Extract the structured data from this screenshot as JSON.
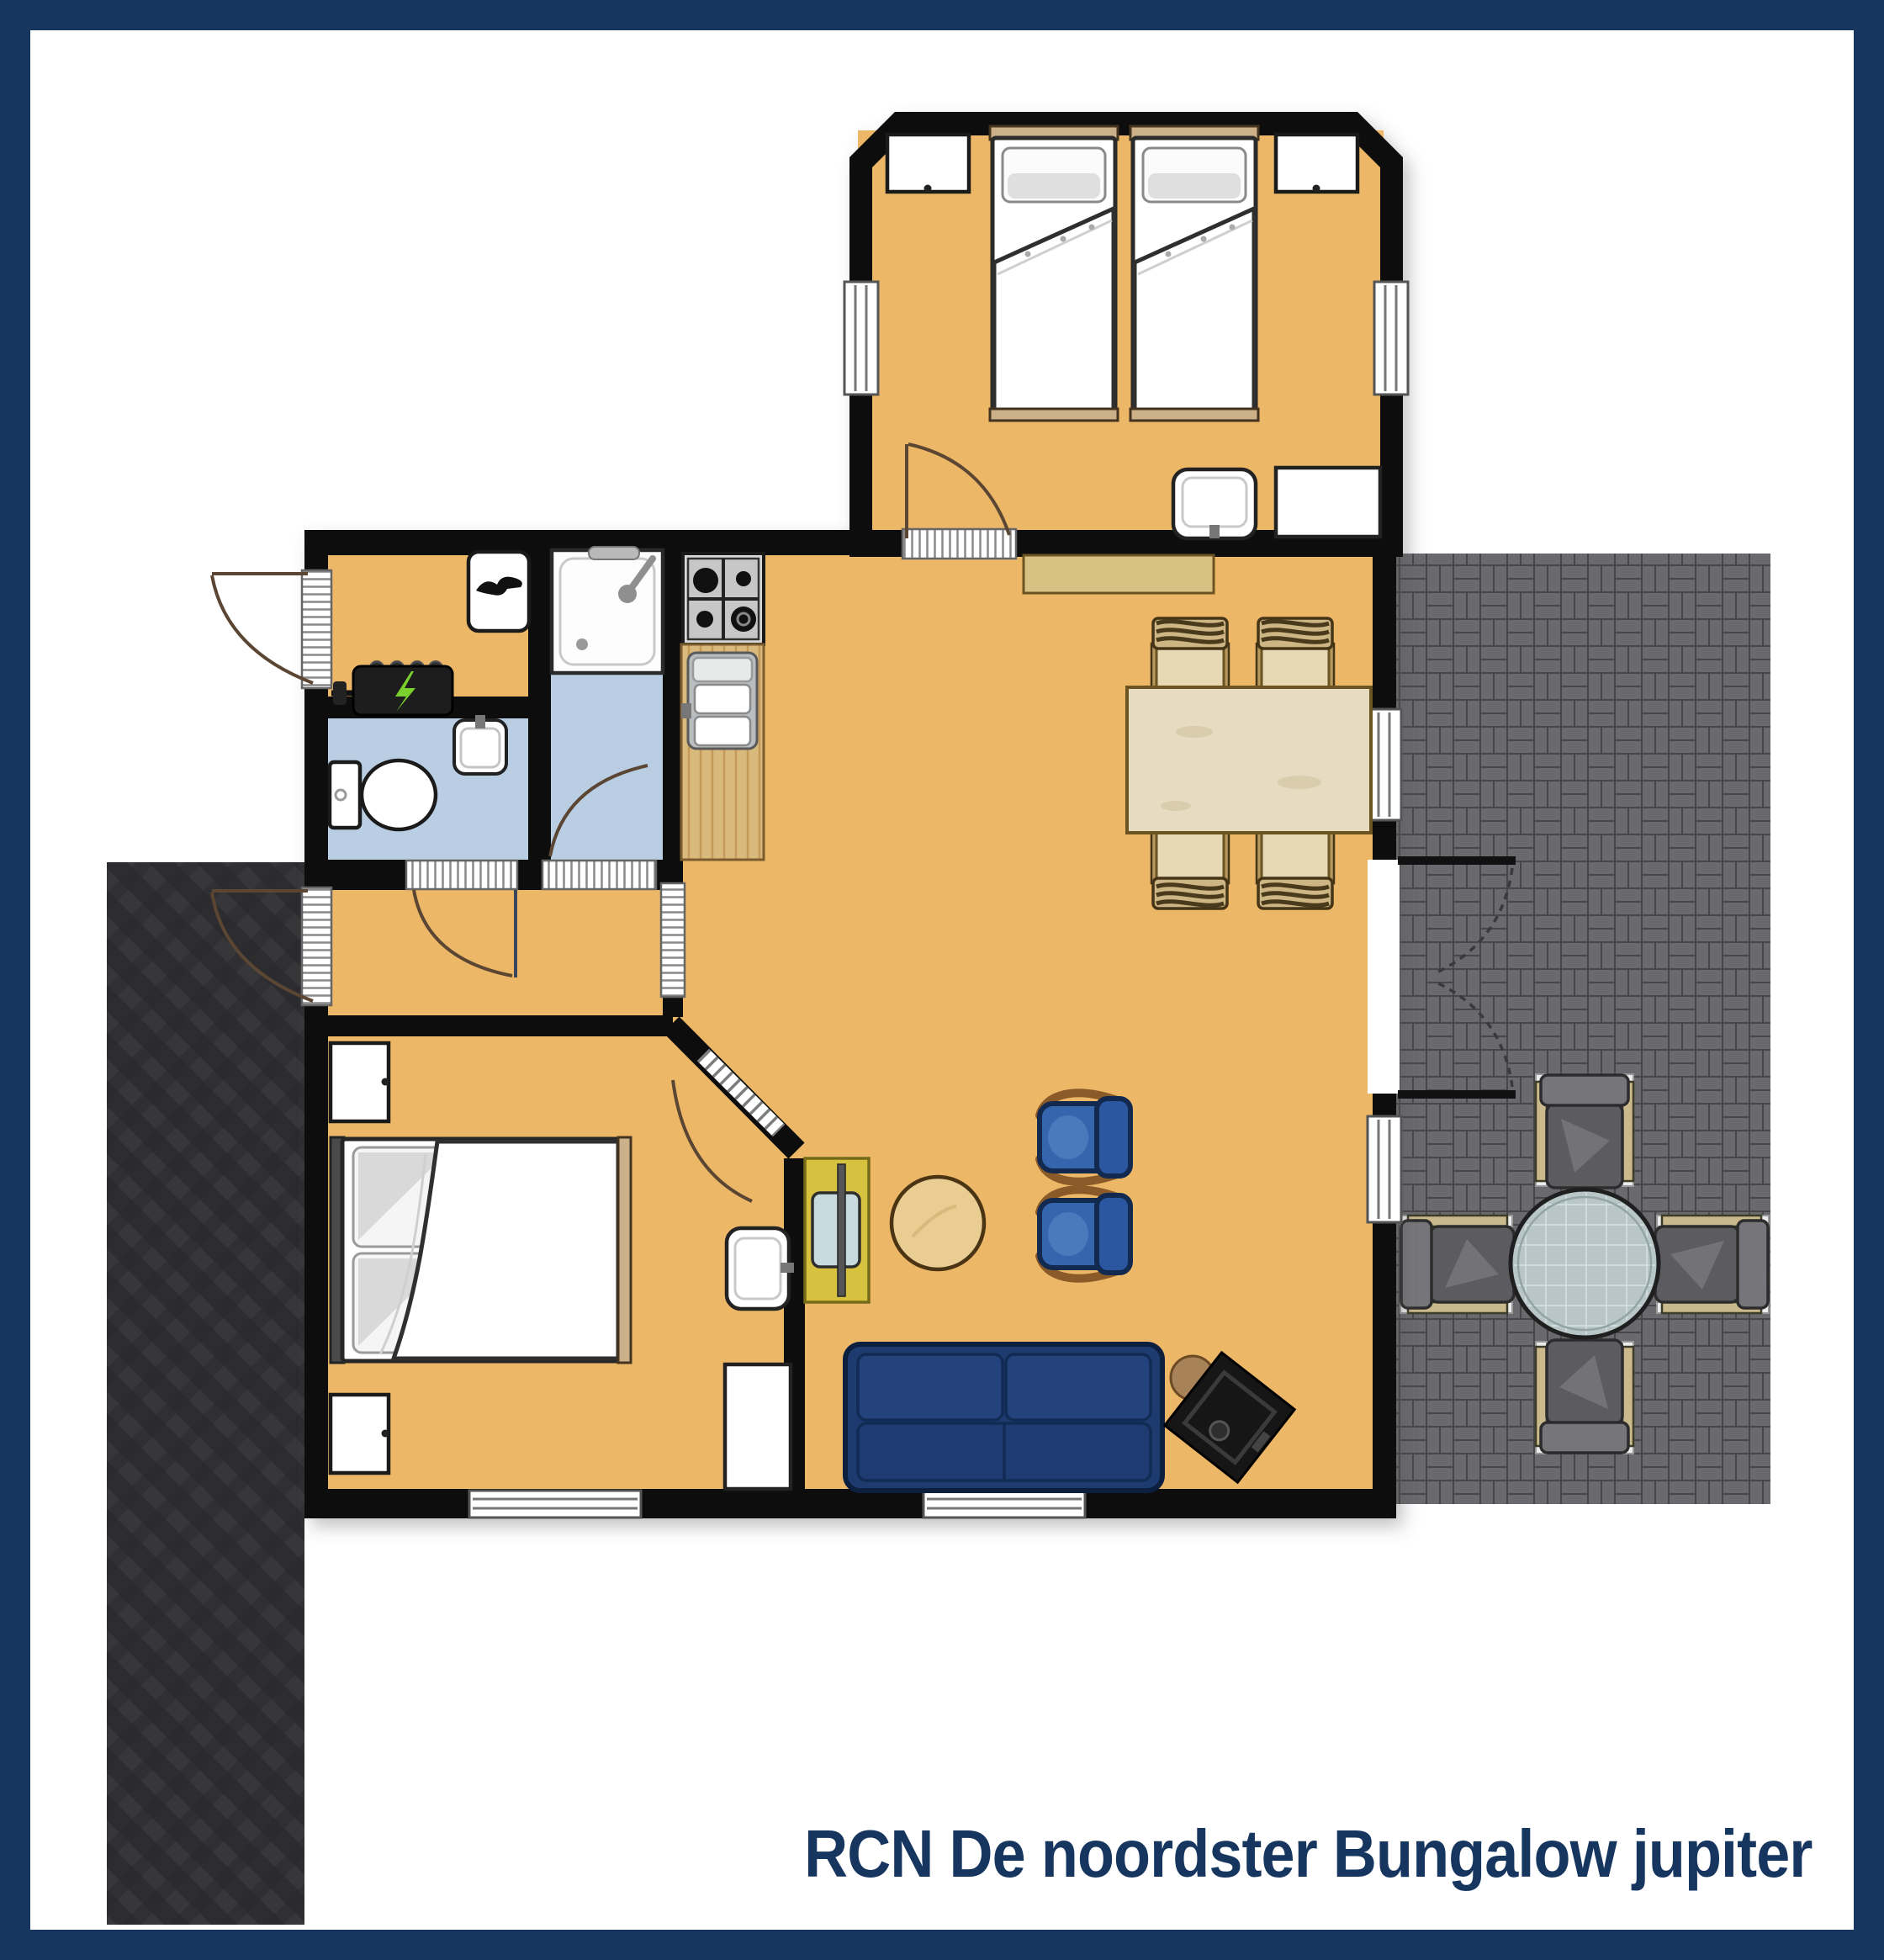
{
  "caption": {
    "text": "RCN De noordster Bungalow jupiter"
  },
  "palette": {
    "frame": "#16365f",
    "wall": "#0e0d0b",
    "floor": "#edb768",
    "wet_floor": "#b9cde3",
    "patio_brick": "#6a6a6e",
    "patio_joint": "#47474a",
    "path_base": "#2d2d30",
    "path_plank": "#37373a",
    "sofa": "#1d3b6e",
    "armchair": "#3566ad",
    "dining_wood": "#e7dcc1",
    "counter_wood": "#d9b97c",
    "sideboard": "#d9c184",
    "tv_cabinet": "#d6c23e",
    "coffee_table": "#e9cd92",
    "bed_frame": "#cbb089",
    "outdoor_seat": "#5c5c60",
    "outdoor_armrest": "#c9b98c",
    "glass_table": "#b9c6c8",
    "lightning_green": "#7ad12e"
  },
  "icons": {
    "boiler_cabinet_icon": "bird",
    "meter_box_icon": "lightning-bolt",
    "shower_icon": "shower-head-and-hose",
    "sink_icon": "faucet"
  },
  "rooms": [
    "twin-bedroom",
    "double-bedroom",
    "living-dining-room",
    "kitchen",
    "shower-room",
    "toilet",
    "entrance-hall",
    "inner-hall",
    "rear-terrace",
    "side-path"
  ]
}
